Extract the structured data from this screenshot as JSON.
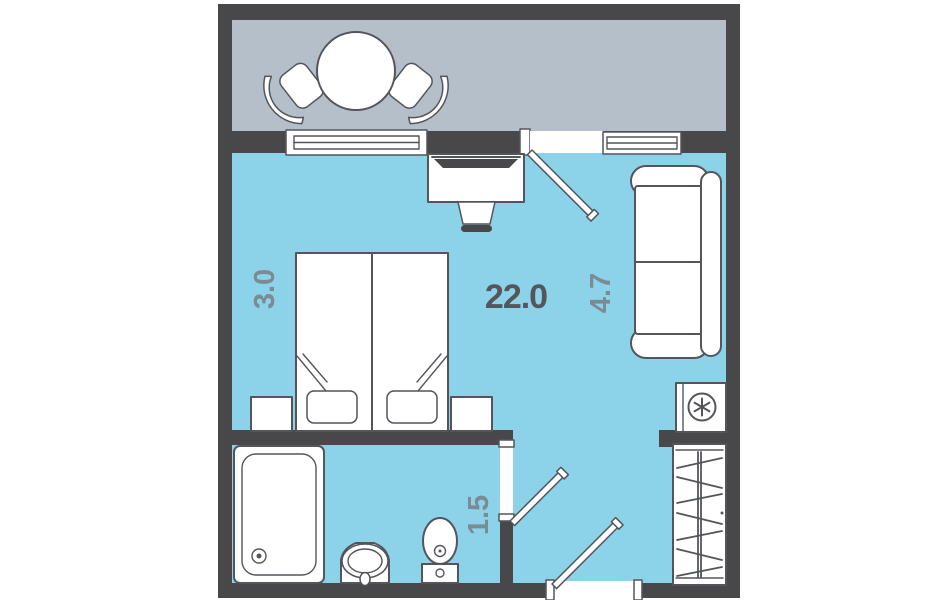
{
  "plan": {
    "labels": {
      "area": "22.0",
      "width": "3.0",
      "length": "4.7",
      "hall": "1.5"
    },
    "colors": {
      "wall": "#48484a",
      "balcony_floor": "#b4bfc9",
      "room_floor": "#8cd2e8",
      "furniture_fill": "#ffffff",
      "furniture_outline": "#53555a",
      "area_label": "#54565a",
      "dimension_label": "#7b8b94"
    },
    "icons": {
      "refrigerator": "snowflake-icon"
    }
  }
}
